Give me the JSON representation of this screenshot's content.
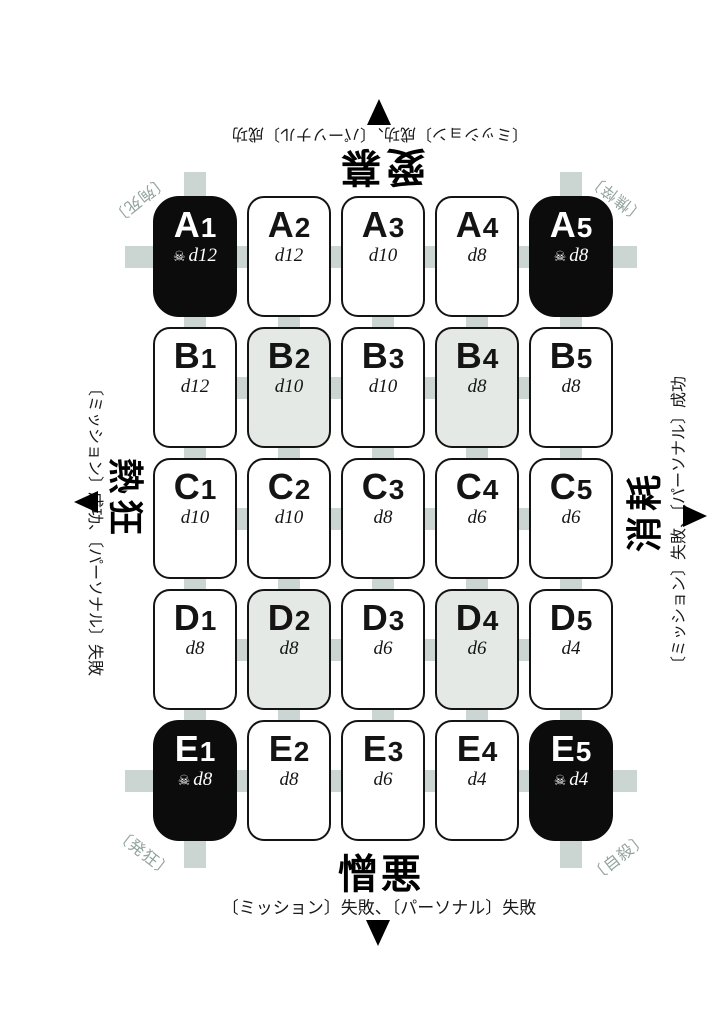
{
  "colors": {
    "background": "#ffffff",
    "connector": "#cbd5d1",
    "cell_white": "#ffffff",
    "cell_gray": "#e4e9e6",
    "cell_black": "#0c0c0c",
    "corner_label": "#92a39c",
    "text": "#141414"
  },
  "axes": {
    "top": {
      "word": "愛慕",
      "instruction": "〔ミッション〕成功、〔パーソナル〕成功",
      "arrow_icon": "up-triangle",
      "flipped": true
    },
    "bottom": {
      "word": "憎悪",
      "instruction": "〔ミッション〕失敗、〔パーソナル〕失敗",
      "arrow_icon": "down-triangle",
      "flipped": false
    },
    "left": {
      "word": "熱狂",
      "instruction": "〔ミッション〕成功、〔パーソナル〕失敗",
      "arrow_icon": "left-triangle",
      "rotated": "90deg"
    },
    "right": {
      "word": "消耗",
      "instruction": "〔ミッション〕失敗、〔パーソナル〕成功",
      "arrow_icon": "right-triangle",
      "rotated": "-90deg"
    }
  },
  "corner_outcomes": {
    "top_left": "〔殉死〕",
    "top_right": "〔憔悴〕",
    "bottom_left": "〔発狂〕",
    "bottom_right": "〔自殺〕"
  },
  "grid": {
    "skull_icon": "☠",
    "rows": [
      "A",
      "B",
      "C",
      "D",
      "E"
    ],
    "cols": [
      "1",
      "2",
      "3",
      "4",
      "5"
    ],
    "cells": [
      {
        "id": "A1",
        "row": "A",
        "col": 1,
        "die": "d12",
        "variant": "black",
        "skull": true
      },
      {
        "id": "A2",
        "row": "A",
        "col": 2,
        "die": "d12",
        "variant": "white",
        "skull": false
      },
      {
        "id": "A3",
        "row": "A",
        "col": 3,
        "die": "d10",
        "variant": "white",
        "skull": false
      },
      {
        "id": "A4",
        "row": "A",
        "col": 4,
        "die": "d8",
        "variant": "white",
        "skull": false
      },
      {
        "id": "A5",
        "row": "A",
        "col": 5,
        "die": "d8",
        "variant": "black",
        "skull": true
      },
      {
        "id": "B1",
        "row": "B",
        "col": 1,
        "die": "d12",
        "variant": "white",
        "skull": false
      },
      {
        "id": "B2",
        "row": "B",
        "col": 2,
        "die": "d10",
        "variant": "gray",
        "skull": false
      },
      {
        "id": "B3",
        "row": "B",
        "col": 3,
        "die": "d10",
        "variant": "white",
        "skull": false
      },
      {
        "id": "B4",
        "row": "B",
        "col": 4,
        "die": "d8",
        "variant": "gray",
        "skull": false
      },
      {
        "id": "B5",
        "row": "B",
        "col": 5,
        "die": "d8",
        "variant": "white",
        "skull": false
      },
      {
        "id": "C1",
        "row": "C",
        "col": 1,
        "die": "d10",
        "variant": "white",
        "skull": false
      },
      {
        "id": "C2",
        "row": "C",
        "col": 2,
        "die": "d10",
        "variant": "white",
        "skull": false
      },
      {
        "id": "C3",
        "row": "C",
        "col": 3,
        "die": "d8",
        "variant": "white",
        "skull": false
      },
      {
        "id": "C4",
        "row": "C",
        "col": 4,
        "die": "d6",
        "variant": "white",
        "skull": false
      },
      {
        "id": "C5",
        "row": "C",
        "col": 5,
        "die": "d6",
        "variant": "white",
        "skull": false
      },
      {
        "id": "D1",
        "row": "D",
        "col": 1,
        "die": "d8",
        "variant": "white",
        "skull": false
      },
      {
        "id": "D2",
        "row": "D",
        "col": 2,
        "die": "d8",
        "variant": "gray",
        "skull": false
      },
      {
        "id": "D3",
        "row": "D",
        "col": 3,
        "die": "d6",
        "variant": "white",
        "skull": false
      },
      {
        "id": "D4",
        "row": "D",
        "col": 4,
        "die": "d6",
        "variant": "gray",
        "skull": false
      },
      {
        "id": "D5",
        "row": "D",
        "col": 5,
        "die": "d4",
        "variant": "white",
        "skull": false
      },
      {
        "id": "E1",
        "row": "E",
        "col": 1,
        "die": "d8",
        "variant": "black",
        "skull": true
      },
      {
        "id": "E2",
        "row": "E",
        "col": 2,
        "die": "d8",
        "variant": "white",
        "skull": false
      },
      {
        "id": "E3",
        "row": "E",
        "col": 3,
        "die": "d6",
        "variant": "white",
        "skull": false
      },
      {
        "id": "E4",
        "row": "E",
        "col": 4,
        "die": "d4",
        "variant": "white",
        "skull": false
      },
      {
        "id": "E5",
        "row": "E",
        "col": 5,
        "die": "d4",
        "variant": "black",
        "skull": true
      }
    ]
  }
}
